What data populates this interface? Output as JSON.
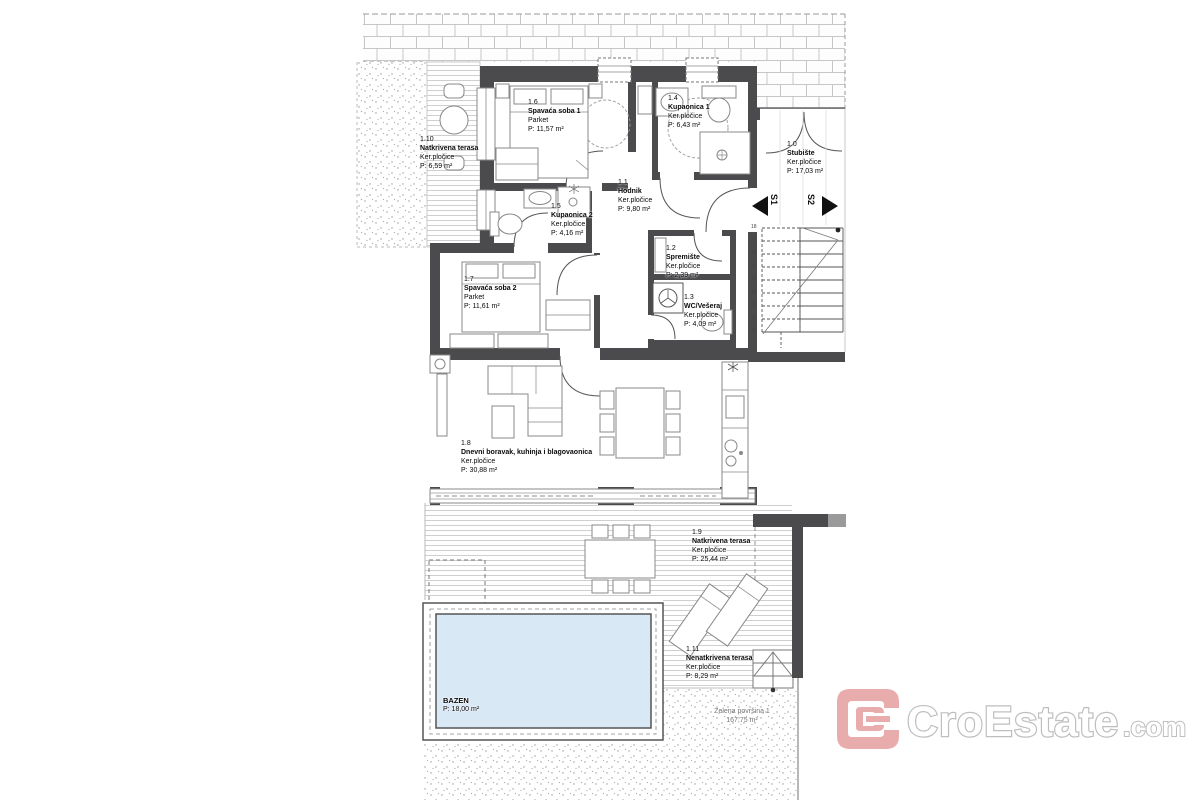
{
  "rooms": [
    {
      "number": "1.0",
      "name": "Stubište",
      "floor": "Ker.pločice",
      "area": "P: 17,03 m²"
    },
    {
      "number": "1.1",
      "name": "Hodnik",
      "floor": "Ker.pločice",
      "area": "P: 9,80 m²"
    },
    {
      "number": "1.2",
      "name": "Spremište",
      "floor": "Ker.pločice",
      "area": "P: 2,39 m²"
    },
    {
      "number": "1.3",
      "name": "WC/Vešeraj",
      "floor": "Ker.pločice",
      "area": "P: 4,09 m²"
    },
    {
      "number": "1.4",
      "name": "Kupaonica 1",
      "floor": "Ker.pločice",
      "area": "P: 6,43 m²"
    },
    {
      "number": "1.5",
      "name": "Kupaonica 2",
      "floor": "Ker.pločice",
      "area": "P: 4,16 m²"
    },
    {
      "number": "1.6",
      "name": "Spavaća soba 1",
      "floor": "Parket",
      "area": "P: 11,57 m²"
    },
    {
      "number": "1.7",
      "name": "Spavaća soba 2",
      "floor": "Parket",
      "area": "P: 11,61 m²"
    },
    {
      "number": "1.8",
      "name": "Dnevni boravak, kuhinja i blagovaonica",
      "floor": "Ker.pločice",
      "area": "P: 30,88 m²"
    },
    {
      "number": "1.9",
      "name": "Natkrivena terasa",
      "floor": "Ker.pločice",
      "area": "P: 25,44 m²"
    },
    {
      "number": "1.10",
      "name": "Natkrivena terasa",
      "floor": "Ker.pločice",
      "area": "P: 6,59 m²"
    },
    {
      "number": "1.11",
      "name": "Nenatkrivena terasa",
      "floor": "Ker.pločice",
      "area": "P: 8,29 m²"
    }
  ],
  "pool": {
    "name": "BAZEN",
    "area": "P: 18,00 m²"
  },
  "green_area": {
    "name": "Zelena površina 1",
    "area": "167,75 m²"
  },
  "section_markers": {
    "s1": "S1",
    "s2": "S2"
  },
  "stairs": {
    "steps": [
      "18",
      "17",
      "16",
      "15",
      "14",
      "13",
      "12",
      "11",
      "10"
    ]
  },
  "logo": {
    "brand": "CroEstate",
    "tld": ".com",
    "accent_color": "#e59a9a",
    "outline_color": "#b3b3b3"
  },
  "colors": {
    "wall": "#4b4b4e",
    "pool_fill": "#d9e8f5",
    "brick_line": "#c6c6c6"
  }
}
